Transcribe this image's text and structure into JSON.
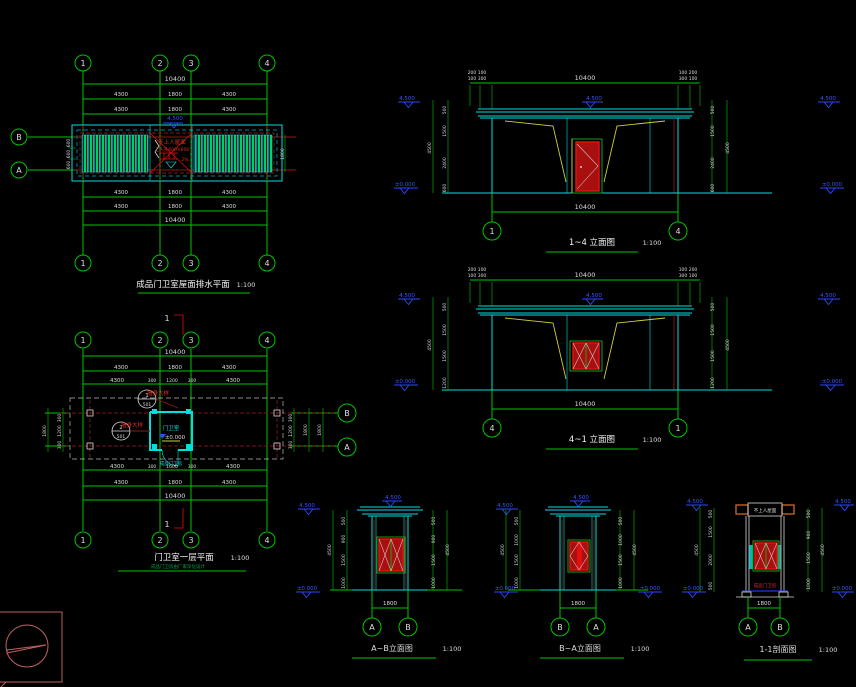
{
  "sheet": {
    "background": "#000000"
  },
  "roof_plan": {
    "title": "成品门卫室屋面排水平面",
    "scale": "1:100",
    "grid_top": [
      "1",
      "2",
      "3",
      "4"
    ],
    "grid_left": [
      "B",
      "A"
    ],
    "dim_total": "10400",
    "spans": [
      "4300",
      "1800",
      "4300"
    ],
    "side_dims": [
      "600",
      "600",
      "600"
    ],
    "side_dim_right": "1800",
    "level": "4.500",
    "center_line1": "不上人屋面",
    "center_line2": "上人孔600×600",
    "slope": "2%"
  },
  "floor_plan": {
    "title": "门卫室一层平面",
    "scale": "1:100",
    "note": "成品门卫房由厂家深化设计",
    "grid_top": [
      "1",
      "2",
      "3",
      "4"
    ],
    "grid_right": [
      "B",
      "A"
    ],
    "dim_total": "10400",
    "spans": [
      "4300",
      "1800",
      "4300"
    ],
    "opening_top": [
      "300",
      "1200",
      "300"
    ],
    "opening_bottom": [
      "300",
      "1600",
      "300"
    ],
    "side_dims": [
      "300",
      "1200",
      "300"
    ],
    "side_total": "1800",
    "room_label": "门卫室",
    "room_level": "±0.000",
    "below_label": "成品门卫房",
    "section_mark": "1",
    "details": [
      {
        "num": "1",
        "sheet": "501",
        "label": "墙身大样"
      },
      {
        "num": "2",
        "sheet": "501",
        "label": "墙身大样"
      }
    ]
  },
  "elev_1_4": {
    "title": "1~4 立面图",
    "scale": "1:100",
    "bubbles": [
      "1",
      "4"
    ],
    "dim_top": "10400",
    "dim_bottom": "10400",
    "cluster_left_1": "200 100",
    "cluster_left_2": "100 300",
    "cluster_right_1": "100 200",
    "cluster_right_2": "300 100",
    "level_top": "4.500",
    "level_ground": "±0.000",
    "vdims": [
      "500",
      "1500",
      "2400",
      "600"
    ],
    "vtotal": "4500"
  },
  "elev_4_1": {
    "title": "4~1 立面图",
    "scale": "1:100",
    "bubbles": [
      "4",
      "1"
    ],
    "dim_top": "10400",
    "dim_bottom": "10400",
    "cluster_left_1": "200 100",
    "cluster_left_2": "100 300",
    "cluster_right_1": "100 200",
    "cluster_right_2": "300 100",
    "level_top": "4.500",
    "level_ground": "±0.000",
    "vdims": [
      "500",
      "1500",
      "1500",
      "1200"
    ],
    "vtotal": "4500"
  },
  "elev_a_b": {
    "title": "A~B立面图",
    "scale": "1:100",
    "bubbles": [
      "A",
      "B"
    ],
    "dim_bottom": "1800",
    "level_top": "4.500",
    "level_ground": "±0.000",
    "vdims": [
      "500",
      "900",
      "1500",
      "1000"
    ],
    "vtotal": "4500"
  },
  "elev_b_a": {
    "title": "B~A立面图",
    "scale": "1:100",
    "bubbles": [
      "B",
      "A"
    ],
    "dim_bottom": "1800",
    "level_top": "4.500",
    "level_ground": "±0.000",
    "vdims": [
      "500",
      "1000",
      "1500",
      "1000"
    ],
    "vtotal": "4500"
  },
  "section_1_1": {
    "title": "1-1剖面图",
    "scale": "1:100",
    "bubbles": [
      "A",
      "B"
    ],
    "dim_bottom": "1800",
    "level_top": "4.500",
    "level_ground": "±0.000",
    "roof_label": "不上人屋面",
    "room_label": "成品门卫房",
    "vdims_left": [
      "500",
      "1500",
      "2000",
      "500"
    ],
    "vdims_right": [
      "500",
      "900",
      "1500",
      "1000"
    ],
    "vtotal": "4500"
  }
}
